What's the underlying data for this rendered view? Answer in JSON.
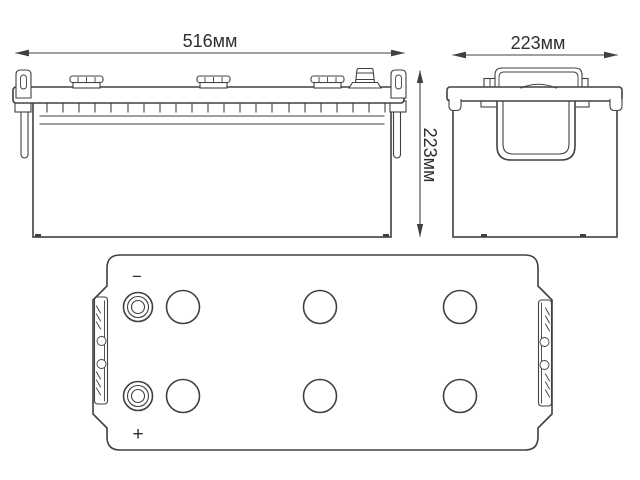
{
  "labels": {
    "front_width": "516мм",
    "side_depth": "223мм",
    "height": "223мм",
    "negative": "−",
    "positive": "+"
  },
  "colors": {
    "line": "#404040",
    "text": "#2e2e2e",
    "background": "#ffffff"
  }
}
